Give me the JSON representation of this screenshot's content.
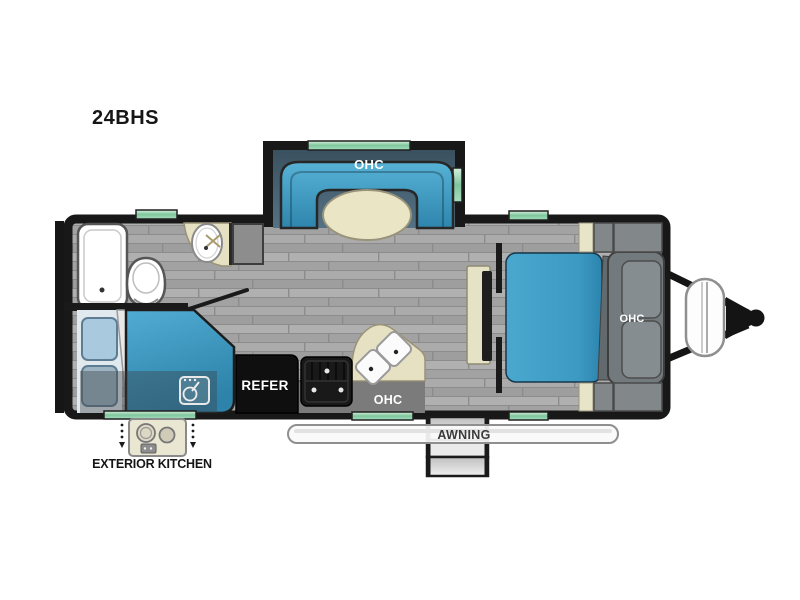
{
  "model": "24BHS",
  "labels": {
    "dinette_ohc": "OHC",
    "bedroom_ohc": "OHC",
    "kitchen_ohc": "OHC",
    "refrigerator": "REFER",
    "awning": "AWNING",
    "exterior_kitchen": "EXTERIOR KITCHEN"
  },
  "areas": {
    "slide_out_dinette": [
      "u-shaped-dinette-sofa",
      "oval-table",
      "overhead-cabinet",
      "top-window",
      "side-window"
    ],
    "bedroom": [
      "queen-bed",
      "headboard-overhead-cabinet",
      "nightstands",
      "tv-panel",
      "wardrobe",
      "privacy-walls"
    ],
    "bathroom": [
      "tub-shower",
      "toilet",
      "corner-sink",
      "cabinet",
      "swing-door",
      "window"
    ],
    "bunkhouse": [
      "double-bunk-beds",
      "bunk-ladder",
      "exterior-kitchen-access"
    ],
    "kitchen": [
      "refrigerator",
      "range-stove",
      "double-sink-counter",
      "overhead-cabinet"
    ],
    "exterior": [
      "awning",
      "entry-door-steps",
      "dual-propane-tanks",
      "a-frame-hitch",
      "rear-bumper",
      "exterior-kitchen-cooktop"
    ]
  },
  "colors": {
    "wall": "#1a1a1a",
    "floor_gray": "#a6a6a6",
    "furniture_blue": "#3d9cc4",
    "slide_interior": "#44606e",
    "counter_beige": "#e7e3c6",
    "window_green": "#8fd0a8",
    "fixture_white": "#ffffff",
    "cabinet_gray": "#868d91",
    "appliance_black": "#111111"
  }
}
